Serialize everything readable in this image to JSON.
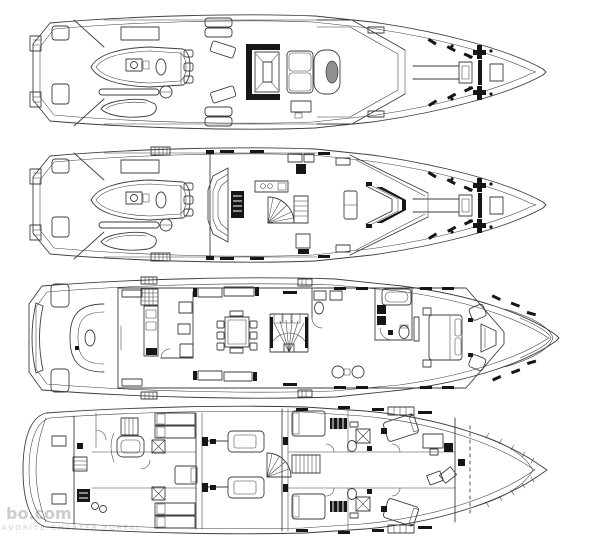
{
  "image": {
    "width": 600,
    "height": 540,
    "background": "#ffffff"
  },
  "colors": {
    "ink": "#3e3e3e",
    "black": "#161616",
    "gray": "#8f8f8f",
    "watermark": "#cdcdcd",
    "background": "#ffffff"
  },
  "watermark": {
    "line1": "bo.com",
    "line2": "AVORITE CHARTER PORTAL"
  },
  "drawing": {
    "type": "yacht-deck-plans",
    "deck_count": 4,
    "decks": [
      {
        "id": "sun-deck",
        "features": [
          "stern-steps",
          "tender",
          "rescue-dinghy",
          "crane",
          "sun-pads",
          "loungers",
          "bar-counter",
          "helm-bench",
          "radar-mast",
          "fore-deck-windlass"
        ]
      },
      {
        "id": "bridge-deck",
        "features": [
          "stern-steps",
          "tender",
          "rescue-dinghy",
          "crane",
          "skylounge",
          "bay-sofa",
          "tv-cabinet",
          "bar",
          "spiral-staircase",
          "wheelhouse",
          "helm-console",
          "fore-deck-windlass"
        ]
      },
      {
        "id": "main-deck",
        "features": [
          "transom-settee",
          "aft-settee",
          "loungers",
          "salon-sofas",
          "galley",
          "dining-table",
          "grand-staircase",
          "day-head",
          "master-bathroom",
          "master-bed",
          "bow-lounge"
        ]
      },
      {
        "id": "lower-deck",
        "features": [
          "lazarette",
          "crew-mess",
          "crew-bunks",
          "crew-stairs",
          "engine-room",
          "twin-engines",
          "guest-cabins",
          "central-staircase",
          "vip-cabins",
          "chain-locker"
        ]
      }
    ]
  }
}
